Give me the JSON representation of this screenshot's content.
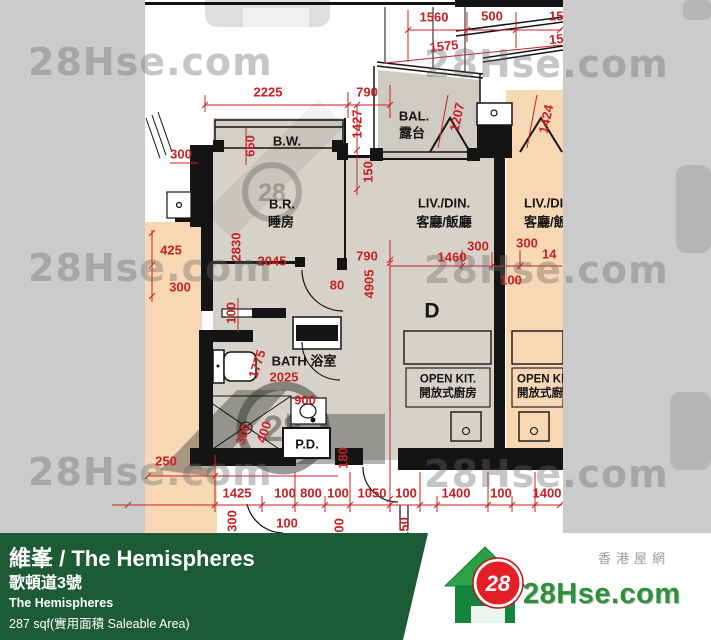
{
  "title_bar": {
    "name_bilingual": "維峯 / The Hemispheres",
    "address": "歌頓道3號",
    "name_en": "The Hemispheres",
    "area": "287 sqf(實用面積 Saleable Area)"
  },
  "logo": {
    "badge": "28",
    "site": "28Hse.com",
    "tagline": "香港屋網"
  },
  "watermark": {
    "text": "28Hse.com",
    "badge": "28",
    "tiles": [
      {
        "x": 28,
        "y": 40
      },
      {
        "x": 424,
        "y": 42
      },
      {
        "x": 28,
        "y": 246
      },
      {
        "x": 424,
        "y": 248
      },
      {
        "x": 28,
        "y": 450
      },
      {
        "x": 424,
        "y": 452
      }
    ]
  },
  "colors": {
    "dimension_red": "#c92121",
    "floor_unit": "#d6d2ca",
    "floor_adjacent": "#f8d7b4",
    "bar_green": "#1c5b33",
    "logo_green": "#2f8f3b",
    "logo_red": "#e41e25",
    "background": "#cbcbcb"
  },
  "plan": {
    "unit_label": "D",
    "rooms": [
      {
        "t": "B.W.",
        "x": 287,
        "y": 141,
        "fs": 13
      },
      {
        "t": "BAL.",
        "x": 414,
        "y": 116,
        "fs": 13
      },
      {
        "t": "露台",
        "x": 412,
        "y": 133,
        "fs": 13
      },
      {
        "t": "B.R.",
        "x": 282,
        "y": 204,
        "fs": 13
      },
      {
        "t": "睡房",
        "x": 281,
        "y": 222,
        "fs": 13
      },
      {
        "t": "LIV./DIN.",
        "x": 444,
        "y": 203,
        "fs": 13
      },
      {
        "t": "客廳/飯廳",
        "x": 444,
        "y": 222,
        "fs": 13
      },
      {
        "t": "LIV./DIN.",
        "x": 524,
        "y": 203,
        "fs": 13,
        "a": "l"
      },
      {
        "t": "客廳/飯廳",
        "x": 524,
        "y": 222,
        "fs": 13,
        "a": "l"
      },
      {
        "t": "D",
        "x": 432,
        "y": 311,
        "fs": 21
      },
      {
        "t": "BATH 浴室",
        "x": 304,
        "y": 361,
        "fs": 13
      },
      {
        "t": "P.D.",
        "x": 307,
        "y": 444,
        "fs": 13
      },
      {
        "t": "OPEN KIT.",
        "x": 448,
        "y": 380,
        "fs": 11.5
      },
      {
        "t": "開放式廚房",
        "x": 448,
        "y": 394,
        "fs": 11.5
      },
      {
        "t": "OPEN KIT.",
        "x": 517,
        "y": 380,
        "fs": 11.5,
        "a": "l"
      },
      {
        "t": "開放式廚房",
        "x": 517,
        "y": 394,
        "fs": 11.5,
        "a": "l"
      }
    ],
    "dimensions": [
      {
        "t": "1560",
        "x": 434,
        "y": 17
      },
      {
        "t": "500",
        "x": 492,
        "y": 16
      },
      {
        "t": "15",
        "x": 549,
        "y": 16,
        "a": "l"
      },
      {
        "t": "1575",
        "x": 444,
        "y": 46,
        "r": -6
      },
      {
        "t": "15",
        "x": 549,
        "y": 39,
        "r": -6,
        "a": "l"
      },
      {
        "t": "2225",
        "x": 268,
        "y": 92
      },
      {
        "t": "790",
        "x": 367,
        "y": 92
      },
      {
        "t": "300",
        "x": 181,
        "y": 154
      },
      {
        "t": "650",
        "x": 250,
        "y": 146,
        "r": -90
      },
      {
        "t": "1427",
        "x": 357,
        "y": 124,
        "r": -90
      },
      {
        "t": "1207",
        "x": 457,
        "y": 117,
        "r": -78
      },
      {
        "t": "1424",
        "x": 546,
        "y": 119,
        "r": -78
      },
      {
        "t": "150",
        "x": 368,
        "y": 172,
        "r": -90
      },
      {
        "t": "2830",
        "x": 236,
        "y": 247,
        "r": -90
      },
      {
        "t": "425",
        "x": 171,
        "y": 250
      },
      {
        "t": "2045",
        "x": 272,
        "y": 261
      },
      {
        "t": "300",
        "x": 180,
        "y": 287
      },
      {
        "t": "790",
        "x": 367,
        "y": 256
      },
      {
        "t": "80",
        "x": 337,
        "y": 285
      },
      {
        "t": "4905",
        "x": 369,
        "y": 284,
        "r": -90
      },
      {
        "t": "1460",
        "x": 452,
        "y": 257
      },
      {
        "t": "300",
        "x": 478,
        "y": 246
      },
      {
        "t": "300",
        "x": 527,
        "y": 243
      },
      {
        "t": "14",
        "x": 542,
        "y": 254,
        "a": "l"
      },
      {
        "t": "100",
        "x": 511,
        "y": 280
      },
      {
        "t": "100",
        "x": 231,
        "y": 313,
        "r": -90
      },
      {
        "t": "1775",
        "x": 257,
        "y": 364,
        "r": -72
      },
      {
        "t": "2025",
        "x": 284,
        "y": 377
      },
      {
        "t": "900",
        "x": 305,
        "y": 400
      },
      {
        "t": "300",
        "x": 243,
        "y": 434,
        "r": -72
      },
      {
        "t": "400",
        "x": 264,
        "y": 432,
        "r": -72
      },
      {
        "t": "180",
        "x": 343,
        "y": 458,
        "r": -90
      },
      {
        "t": "250",
        "x": 166,
        "y": 461
      },
      {
        "t": "1425",
        "x": 237,
        "y": 493
      },
      {
        "t": "100",
        "x": 285,
        "y": 493
      },
      {
        "t": "800",
        "x": 311,
        "y": 493
      },
      {
        "t": "100",
        "x": 338,
        "y": 493
      },
      {
        "t": "1050",
        "x": 372,
        "y": 493
      },
      {
        "t": "100",
        "x": 406,
        "y": 493
      },
      {
        "t": "1400",
        "x": 456,
        "y": 493
      },
      {
        "t": "100",
        "x": 501,
        "y": 493
      },
      {
        "t": "1400",
        "x": 547,
        "y": 493
      },
      {
        "t": "300",
        "x": 232,
        "y": 521,
        "r": -90
      },
      {
        "t": "100",
        "x": 287,
        "y": 523
      },
      {
        "t": "700",
        "x": 339,
        "y": 529,
        "r": -90
      },
      {
        "t": "150",
        "x": 404,
        "y": 528,
        "r": -90
      }
    ]
  }
}
